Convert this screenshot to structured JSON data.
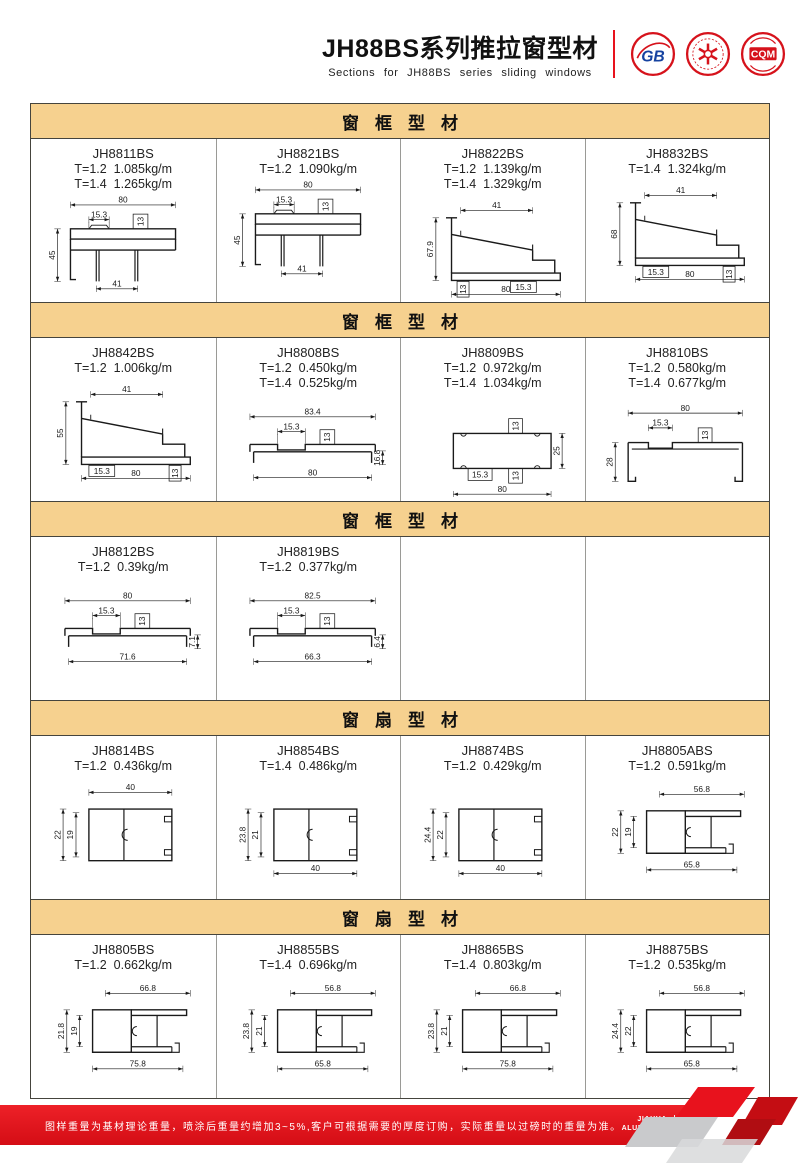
{
  "header": {
    "title": "JH88BS系列推拉窗型材",
    "subtitle": "Sections for JH88BS series sliding windows",
    "gb_logo_label": "GB",
    "cqm_logo_label": "CQM"
  },
  "colors": {
    "accent_red": "#e8121d",
    "section_header_bg": "#f6d18f",
    "border_dark": "#45443d",
    "border_light": "#9a9a96",
    "drawing_stroke": "#1a1a1a"
  },
  "sections": [
    {
      "title": "窗框型材",
      "cells": [
        {
          "code": "JH8811BS",
          "specs": [
            "T=1.2  1.085kg/m",
            "T=1.4  1.265kg/m"
          ],
          "drawing": {
            "type": "frame-top",
            "dims": {
              "top": "80",
              "slot": "15.3",
              "tab": "13",
              "left": "45",
              "bottom": "41"
            }
          }
        },
        {
          "code": "JH8821BS",
          "specs": [
            "T=1.2  1.090kg/m"
          ],
          "drawing": {
            "type": "frame-top",
            "dims": {
              "top": "80",
              "slot": "15.3",
              "tab": "13",
              "left": "45",
              "bottom": "41"
            }
          }
        },
        {
          "code": "JH8822BS",
          "specs": [
            "T=1.2  1.139kg/m",
            "T=1.4  1.329kg/m"
          ],
          "drawing": {
            "type": "frame-sloped",
            "dims": {
              "top": "41",
              "left": "67.9",
              "b_left": "13",
              "b_left_vert": true,
              "b_mid": "80",
              "b_right": "15.3",
              "b_right_vert": false
            }
          }
        },
        {
          "code": "JH8832BS",
          "specs": [
            "T=1.4  1.324kg/m"
          ],
          "drawing": {
            "type": "frame-sloped",
            "dims": {
              "top": "41",
              "left": "68",
              "b_left": "15.3",
              "b_left_vert": false,
              "b_mid": "80",
              "b_right": "13",
              "b_right_vert": true
            }
          }
        }
      ]
    },
    {
      "title": "窗框型材",
      "cells": [
        {
          "code": "JH8842BS",
          "specs": [
            "T=1.2  1.006kg/m"
          ],
          "drawing": {
            "type": "frame-sloped",
            "dims": {
              "top": "41",
              "left": "55",
              "b_left": "15.3",
              "b_left_vert": false,
              "b_mid": "80",
              "b_right": "13",
              "b_right_vert": true
            }
          }
        },
        {
          "code": "JH8808BS",
          "specs": [
            "T=1.2  0.450kg/m",
            "T=1.4  0.525kg/m"
          ],
          "drawing": {
            "type": "flat-rail",
            "dims": {
              "top": "83.4",
              "slot": "15.3",
              "tab": "13",
              "bottom": "80",
              "right": "16.8"
            }
          }
        },
        {
          "code": "JH8809BS",
          "specs": [
            "T=1.2  0.972kg/m",
            "T=1.4  1.034kg/m"
          ],
          "drawing": {
            "type": "box",
            "dims": {
              "tab_top": "13",
              "right": "25",
              "slot": "15.3",
              "tab_bottom": "13",
              "bottom": "80"
            }
          }
        },
        {
          "code": "JH8810BS",
          "specs": [
            "T=1.2  0.580kg/m",
            "T=1.4  0.677kg/m"
          ],
          "drawing": {
            "type": "channel",
            "dims": {
              "top": "80",
              "slot": "15.3",
              "tab": "13",
              "left": "28"
            }
          }
        }
      ]
    },
    {
      "title": "窗框型材",
      "cells": [
        {
          "code": "JH8812BS",
          "specs": [
            "T=1.2  0.39kg/m"
          ],
          "drawing": {
            "type": "flat-rail",
            "dims": {
              "top": "80",
              "slot": "15.3",
              "tab": "13",
              "bottom": "71.6",
              "right": "7.1"
            }
          }
        },
        {
          "code": "JH8819BS",
          "specs": [
            "T=1.2  0.377kg/m"
          ],
          "drawing": {
            "type": "flat-rail",
            "dims": {
              "top": "82.5",
              "slot": "15.3",
              "tab": "13",
              "bottom": "66.3",
              "right": "6.4"
            }
          }
        },
        {},
        {}
      ]
    },
    {
      "title": "窗扇型材",
      "cells": [
        {
          "code": "JH8814BS",
          "specs": [
            "T=1.2  0.436kg/m"
          ],
          "drawing": {
            "type": "sash",
            "dims": {
              "top": "40",
              "left_outer": "22",
              "left_inner": "19"
            }
          }
        },
        {
          "code": "JH8854BS",
          "specs": [
            "T=1.4  0.486kg/m"
          ],
          "drawing": {
            "type": "sash",
            "dims": {
              "left_outer": "23.8",
              "left_inner": "21",
              "bottom": "40"
            }
          }
        },
        {
          "code": "JH8874BS",
          "specs": [
            "T=1.2  0.429kg/m"
          ],
          "drawing": {
            "type": "sash",
            "dims": {
              "left_outer": "24.4",
              "left_inner": "22",
              "bottom": "40"
            }
          }
        },
        {
          "code": "JH8805ABS",
          "specs": [
            "T=1.2  0.591kg/m"
          ],
          "drawing": {
            "type": "sash-flange",
            "dims": {
              "top": "56.8",
              "left_outer": "22",
              "left_inner": "19",
              "bottom": "65.8"
            }
          }
        }
      ]
    },
    {
      "title": "窗扇型材",
      "cells": [
        {
          "code": "JH8805BS",
          "specs": [
            "T=1.2  0.662kg/m"
          ],
          "drawing": {
            "type": "sash-flange",
            "dims": {
              "top": "66.8",
              "left_outer": "21.8",
              "left_inner": "19",
              "bottom": "75.8"
            }
          }
        },
        {
          "code": "JH8855BS",
          "specs": [
            "T=1.4  0.696kg/m"
          ],
          "drawing": {
            "type": "sash-flange",
            "dims": {
              "top": "56.8",
              "left_outer": "23.8",
              "left_inner": "21",
              "bottom": "65.8"
            }
          }
        },
        {
          "code": "JH8865BS",
          "specs": [
            "T=1.4  0.803kg/m"
          ],
          "drawing": {
            "type": "sash-flange",
            "dims": {
              "top": "66.8",
              "left_outer": "23.8",
              "left_inner": "21",
              "bottom": "75.8"
            }
          }
        },
        {
          "code": "JH8875BS",
          "specs": [
            "T=1.2  0.535kg/m"
          ],
          "drawing": {
            "type": "sash-flange",
            "dims": {
              "top": "56.8",
              "left_outer": "24.4",
              "left_inner": "22",
              "bottom": "65.8"
            }
          }
        }
      ]
    }
  ],
  "footer": {
    "note": "图样重量为基材理论重量，喷涂后重量约增加3~5%,客户可根据需要的厚度订购，实际重量以过磅时的重量为准。",
    "brand_line1": "JIAHUA",
    "brand_line2": "ALUMINIUM",
    "page_number": "31"
  }
}
